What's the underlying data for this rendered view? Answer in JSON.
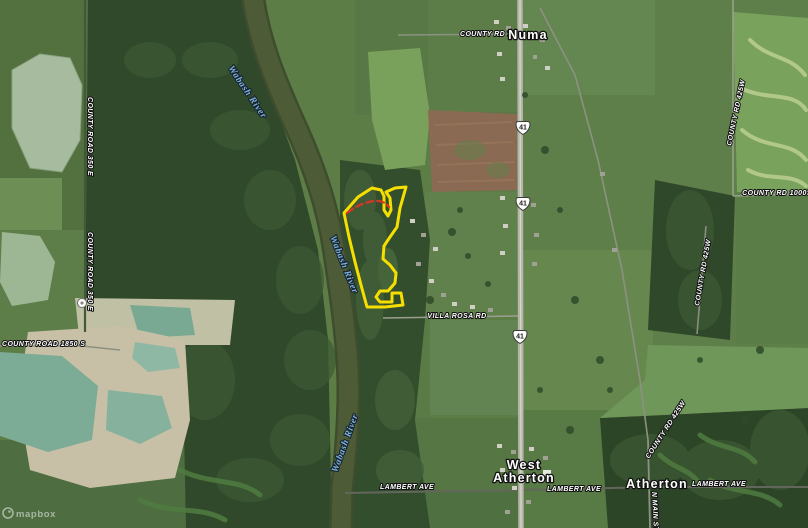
{
  "map": {
    "type": "satellite",
    "attribution": "mapbox",
    "colors": {
      "parcel_outline": "#F6DF00",
      "parcel_inner_line": "#D93425",
      "water_label": "#7FB2DE",
      "label_text": "#FFFFFF",
      "label_halo": "#111111",
      "highway_fill": "#B5B5AA",
      "river_fill": "#4D5C36",
      "field_green": "#5D7D47",
      "forest_green": "#2F4829",
      "pond_teal": "#7CAB96",
      "tilled_field_brown": "#8A6A52",
      "quarry_sand": "#C7C0A6"
    }
  },
  "place_labels": [
    {
      "id": "numa",
      "text": "Numa"
    },
    {
      "id": "west-atherton-line1",
      "text": "West"
    },
    {
      "id": "west-atherton-line2",
      "text": "Atherton"
    },
    {
      "id": "atherton",
      "text": "Atherton"
    }
  ],
  "road_labels": [
    {
      "id": "county-rd-72",
      "text": "COUNTY RD 72"
    },
    {
      "id": "county-rd-425w-north",
      "text": "COUNTY RD 425W"
    },
    {
      "id": "county-rd-1000s",
      "text": "COUNTY RD 1000S"
    },
    {
      "id": "county-rd-425w-mid",
      "text": "COUNTY RD 425W"
    },
    {
      "id": "county-rd-425w-south",
      "text": "COUNTY RD 425W"
    },
    {
      "id": "n-main-st",
      "text": "N MAIN ST"
    },
    {
      "id": "lambert-ave-west",
      "text": "LAMBERT AVE"
    },
    {
      "id": "lambert-ave-center",
      "text": "LAMBERT AVE"
    },
    {
      "id": "lambert-ave-east",
      "text": "LAMBERT AVE"
    },
    {
      "id": "villa-rosa-rd",
      "text": "VILLA ROSA RD"
    },
    {
      "id": "county-road-350e-north",
      "text": "COUNTY ROAD 350 E"
    },
    {
      "id": "county-road-350e-south",
      "text": "COUNTY ROAD 350 E"
    },
    {
      "id": "county-road-1850s",
      "text": "COUNTY ROAD 1850 S"
    }
  ],
  "water_labels": [
    {
      "id": "wabash-river-north",
      "text": "Wabash River"
    },
    {
      "id": "wabash-river-mid",
      "text": "Wabash River"
    },
    {
      "id": "wabash-river-south",
      "text": "Wabash River"
    }
  ],
  "highway_shields": [
    {
      "id": "us-41-north",
      "route": "41"
    },
    {
      "id": "us-41-mid",
      "route": "41"
    },
    {
      "id": "us-41-south",
      "route": "41"
    }
  ]
}
